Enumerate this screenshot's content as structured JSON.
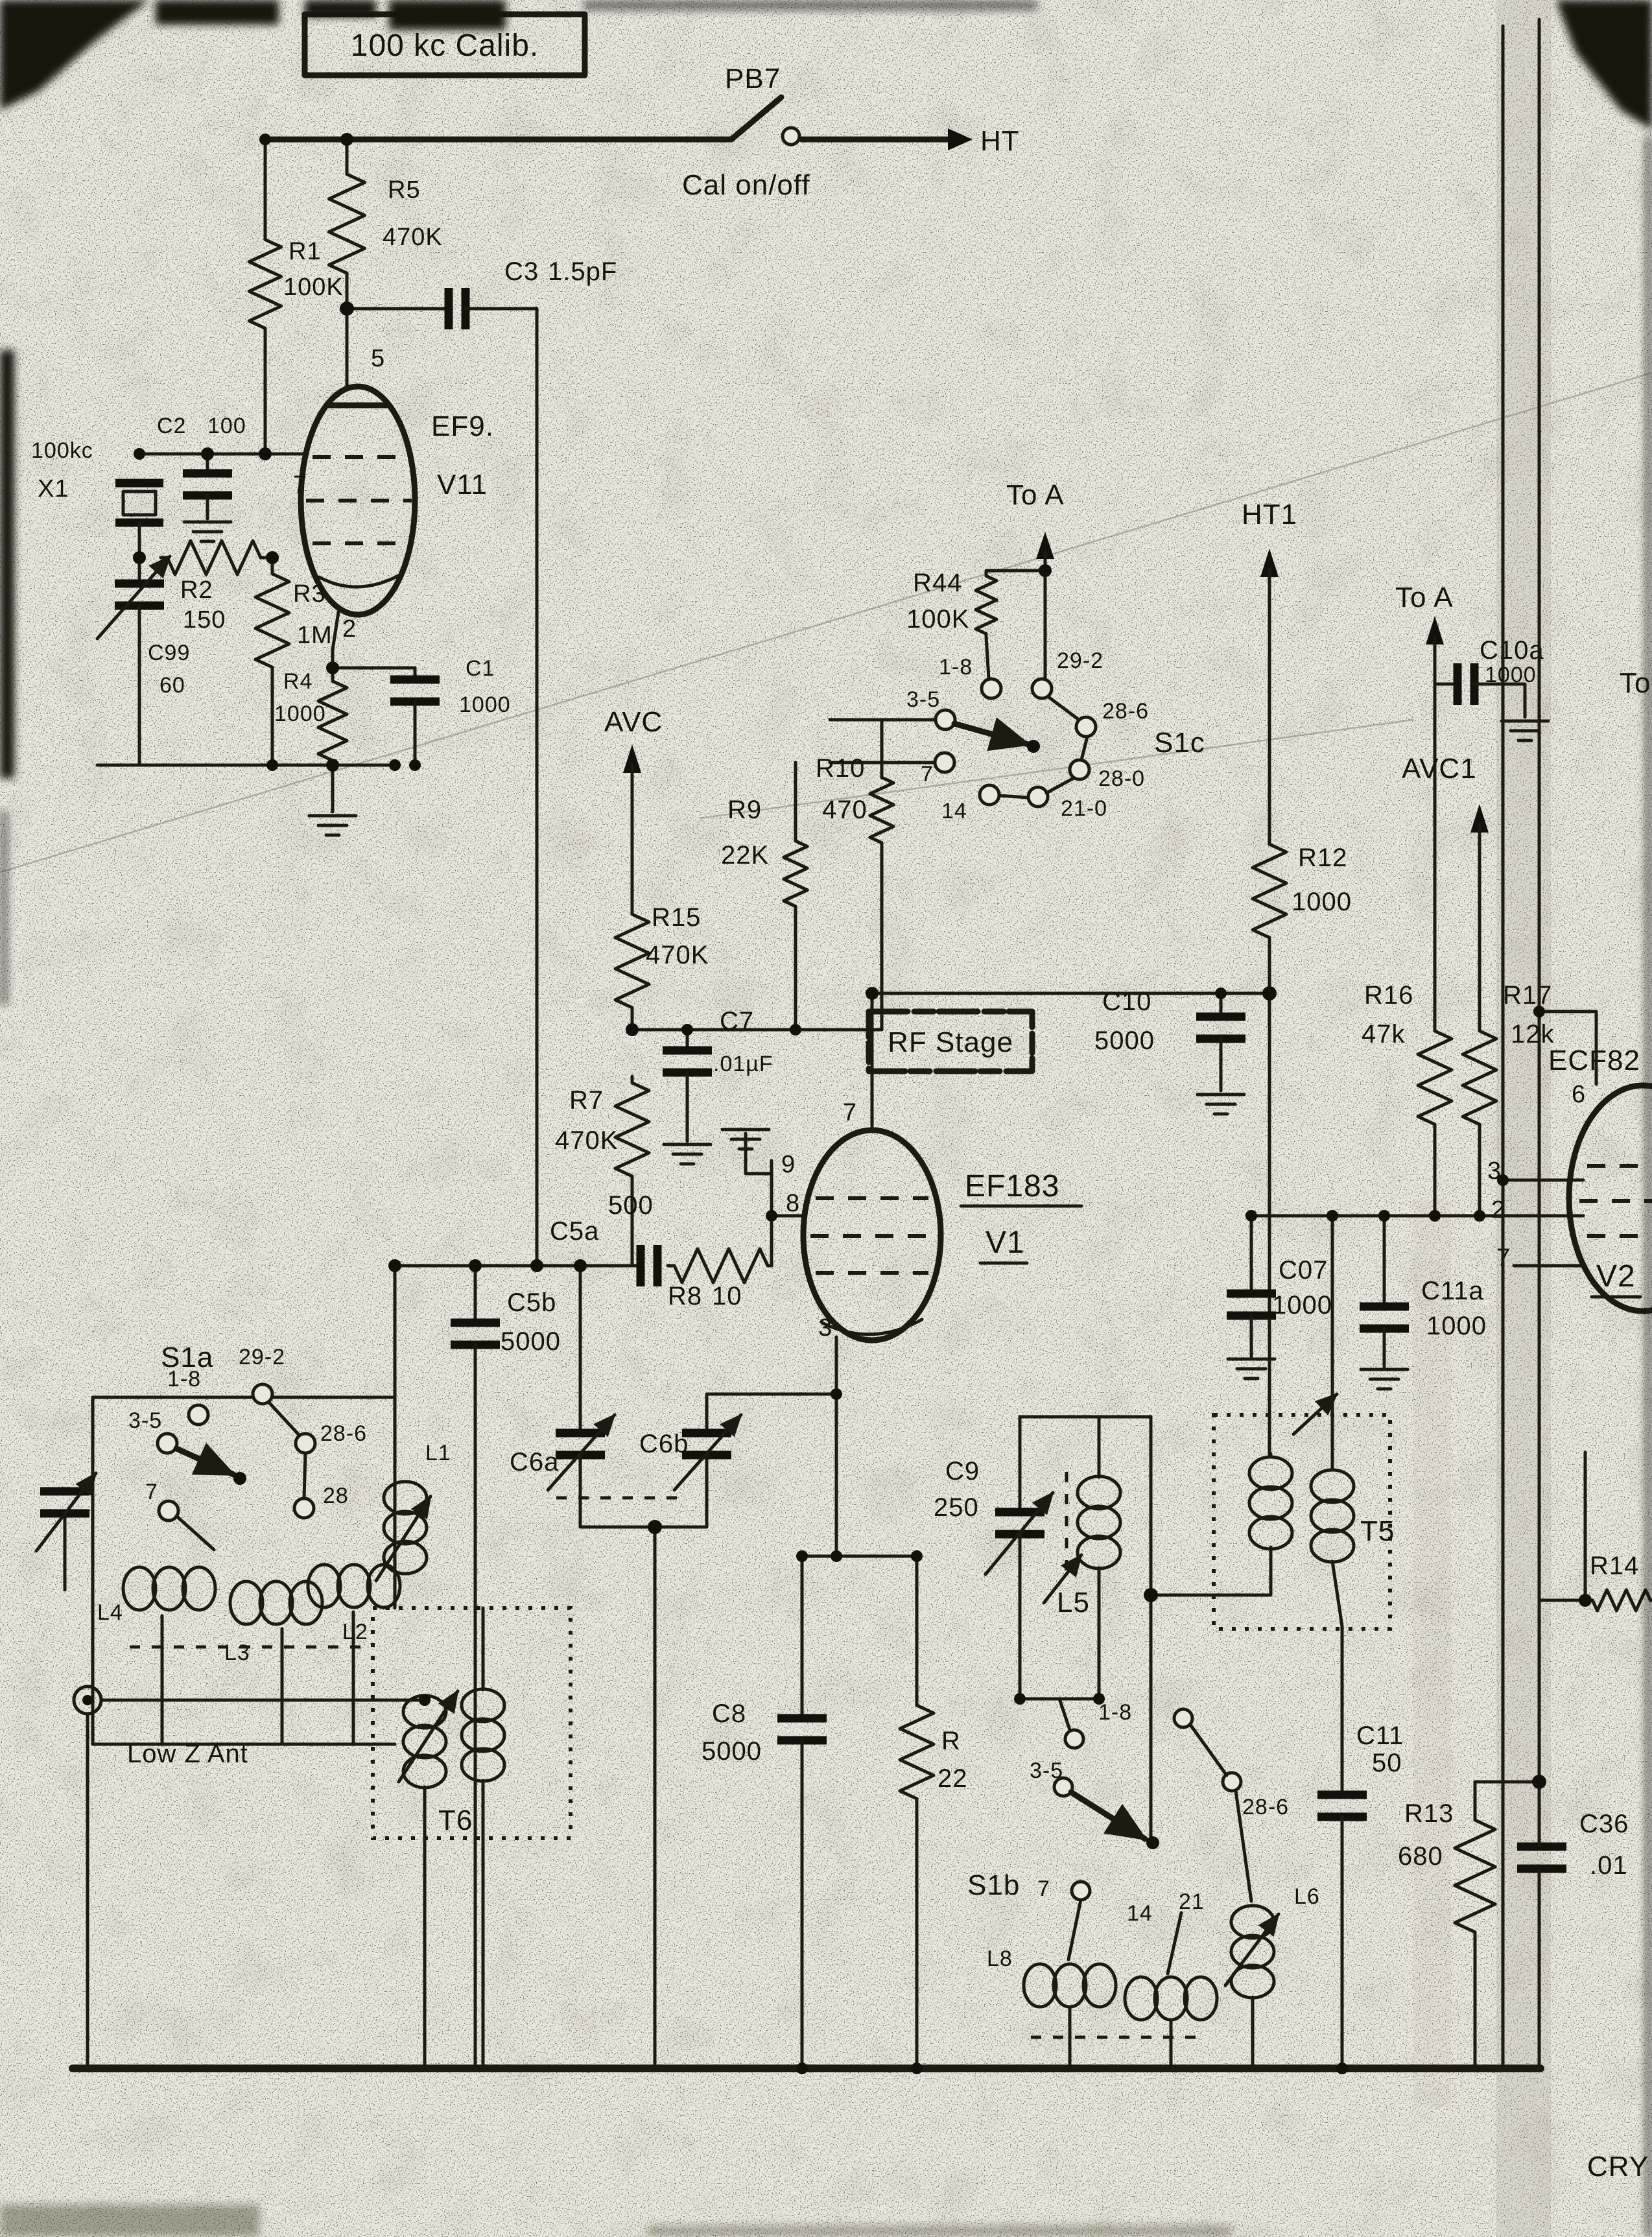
{
  "title": "100 kc Calib.",
  "top": {
    "pb7": "PB7",
    "cal": "Cal on/off",
    "ht": "HT"
  },
  "cal": {
    "r1": {
      "r": "R1",
      "v": "100K"
    },
    "r5": {
      "r": "R5",
      "v": "470K"
    },
    "c3": {
      "r": "C3",
      "v": "1.5pF"
    },
    "c2": {
      "r": "C2",
      "v": "100"
    },
    "x1": {
      "r": "X1",
      "v": "100kc"
    },
    "r2": {
      "r": "R2",
      "v": "150"
    },
    "r3": {
      "r": "R3",
      "v": "1M"
    },
    "c99": {
      "r": "C99",
      "v": "60"
    },
    "r4": {
      "r": "R4",
      "v": "1000"
    },
    "c1": {
      "r": "C1",
      "v": "1000"
    },
    "tube": {
      "type": "EF9.",
      "name": "V11",
      "p5": "5",
      "p7": "7",
      "p2": "2"
    }
  },
  "mid": {
    "toa": "To A",
    "r44": {
      "r": "R44",
      "v": "100K"
    },
    "s1c": {
      "name": "S1c",
      "c18": "1-8",
      "c292": "29-2",
      "c35": "3-5",
      "c286": "28-6",
      "c280": "28-0",
      "c210": "21-0",
      "c14": "14",
      "c7": "7"
    },
    "avc": "AVC",
    "r9": {
      "r": "R9",
      "v": "22K"
    },
    "r10": {
      "r": "R10",
      "v": "470"
    },
    "r15": {
      "r": "R15",
      "v": "470K"
    },
    "c7": {
      "r": "C7",
      "v": ".01µF"
    },
    "r7": {
      "r": "R7",
      "v": "470K"
    }
  },
  "rf": {
    "box": "RF Stage",
    "tube": {
      "type": "EF183",
      "name": "V1",
      "p7": "7",
      "p9": "9",
      "p8": "8",
      "p3": "3"
    },
    "c5a": {
      "r": "C5a",
      "v": "500"
    },
    "c5b": {
      "r": "C5b",
      "v": "5000"
    },
    "r8": {
      "r": "R8",
      "v": "10"
    },
    "c10": {
      "r": "C10",
      "v": "5000"
    },
    "r12": {
      "r": "R12",
      "v": "1000"
    },
    "ht1": "HT1",
    "c8": {
      "r": "C8",
      "v": "5000"
    },
    "r11": {
      "r": "R",
      "v": "22"
    },
    "c6a": "C6a",
    "c6b": "C6b"
  },
  "ant": {
    "s1a": {
      "name": "S1a",
      "c18": "1-8",
      "c292": "29-2",
      "c35": "3-5",
      "c286": "28-6",
      "c28": "28",
      "c7": "7"
    },
    "l1": "L1",
    "l2": "L2",
    "l3": "L3",
    "l4": "L4",
    "t6": "T6",
    "lowz": "Low Z Ant"
  },
  "right": {
    "toa": "To A",
    "to": "To",
    "c10a": {
      "r": "C10a",
      "v": "1000"
    },
    "avc1": "AVC1",
    "r16": {
      "r": "R16",
      "v": "47k"
    },
    "r17": {
      "r": "R17",
      "v": "12k"
    },
    "ecf82": "ECF82",
    "v2": "V2",
    "p6": "6",
    "p3": "3",
    "p2": "2",
    "p7": "7",
    "c07": {
      "r": "C07",
      "v": "1000"
    },
    "c11a": {
      "r": "C11a",
      "v": "1000"
    },
    "t5": "T5",
    "r14": "R14"
  },
  "tun": {
    "c9": {
      "r": "C9",
      "v": "250"
    },
    "l5": "L5",
    "s1b": {
      "name": "S1b",
      "c18": "1-8",
      "c35": "3-5",
      "c7": "7",
      "c14": "14",
      "c21": "21",
      "c286": "28-6"
    },
    "l8": "L8",
    "l6": "L6",
    "c11": {
      "r": "C11",
      "v": "50"
    },
    "r13": {
      "r": "R13",
      "v": "680"
    },
    "c36": {
      "r": "C36",
      "v": ".01"
    }
  },
  "corner": "CRY"
}
